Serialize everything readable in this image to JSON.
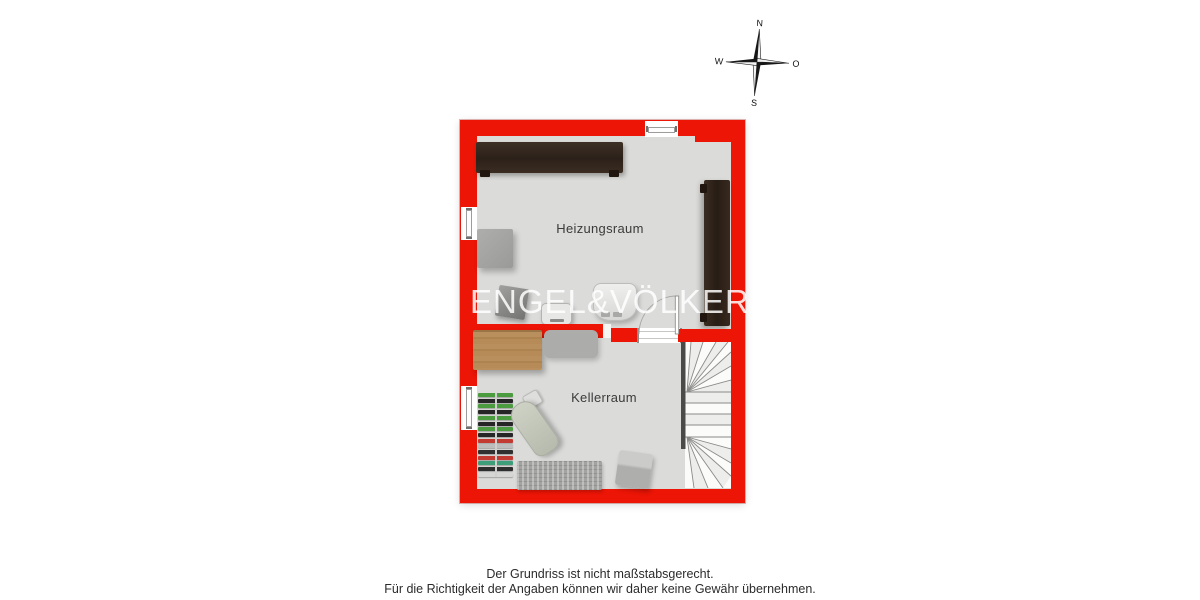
{
  "compass": {
    "north": "N",
    "south": "S",
    "west": "W",
    "east": "O"
  },
  "plan": {
    "watermark": "ENGEL&VÖLKERS",
    "rooms": [
      {
        "label": "Heizungsraum"
      },
      {
        "label": "Kellerraum"
      }
    ]
  },
  "disclaimer": {
    "line1": "Der Grundriss ist nicht maßstabsgerecht.",
    "line2": "Für die Richtigkeit der Angaben können wir daher keine Gewähr übernehmen."
  },
  "colors": {
    "wall_red": "#ec1506",
    "floor_gray": "#dbdbd9",
    "beam_brown": "#362a20",
    "wood_table": "#b68b58",
    "stair_tread": "#f6f6f5"
  },
  "kellerraum_rack_colors": [
    "#4a9c3f",
    "#262626",
    "#4a9c3f",
    "#262626",
    "#4a9c3f",
    "#262626",
    "#4a9c3f",
    "#262626",
    "#c23a32",
    "#bdbdbd",
    "#303030",
    "#c23a32",
    "#3f9e7a",
    "#2e2e2e",
    "#d6d6d4"
  ]
}
